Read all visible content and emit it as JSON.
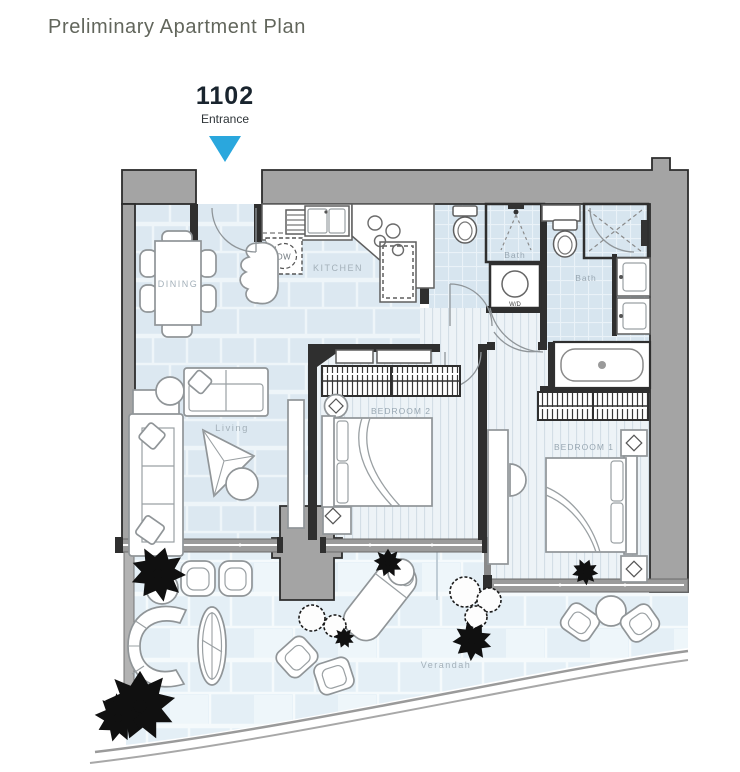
{
  "header": {
    "title": "Preliminary Apartment Plan",
    "unit_number": "1102",
    "entrance_label": "Entrance"
  },
  "plan": {
    "rooms": [
      {
        "id": "dining",
        "label": "DINING"
      },
      {
        "id": "kitchen",
        "label": "KITCHEN"
      },
      {
        "id": "living",
        "label": "Living"
      },
      {
        "id": "bedroom2",
        "label": "BEDROOM 2"
      },
      {
        "id": "bedroom1",
        "label": "BEDROOM 1"
      },
      {
        "id": "bath1",
        "label": "Bath"
      },
      {
        "id": "bath2",
        "label": "Bath"
      },
      {
        "id": "verandah",
        "label": "Verandah"
      }
    ],
    "appliances": {
      "dishwasher": "DW",
      "washer_dryer": "W/D"
    }
  },
  "colors": {
    "accent_arrow": "#2aa7dd",
    "wall_gray": "#a4a4a4",
    "wall_dark": "#2f2f2f",
    "floor_tile": "#dce8f1",
    "bath_tile": "#d7e5ef",
    "plank_floor": "#edf3f7",
    "label_text": "#a3b0b9",
    "title_text": "#62665c",
    "unit_text": "#19242e"
  }
}
